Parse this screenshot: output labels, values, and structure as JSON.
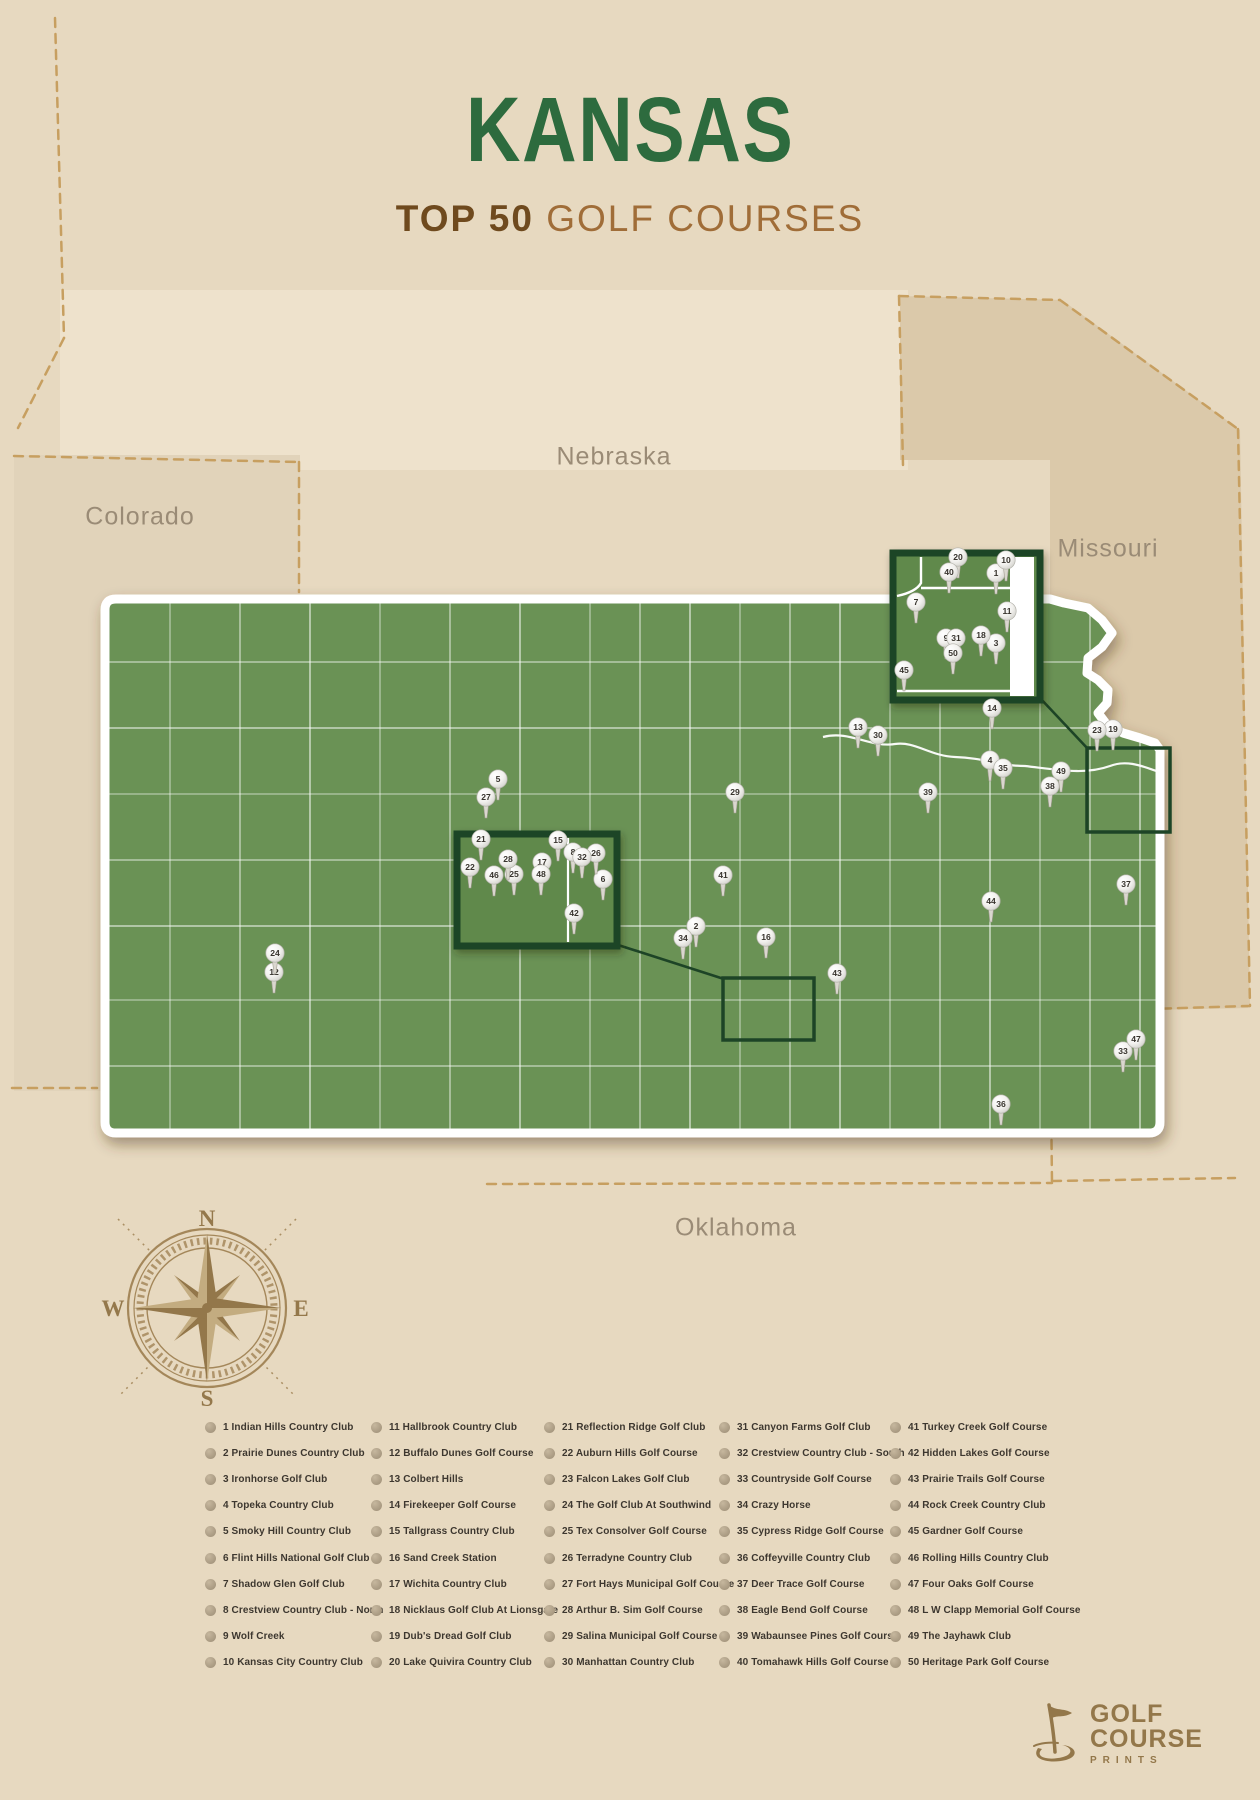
{
  "title": {
    "main": "KANSAS",
    "subtitle_bold": "TOP 50",
    "subtitle_light": " GOLF COURSES"
  },
  "states": [
    {
      "name": "Colorado",
      "x": 140,
      "y": 517
    },
    {
      "name": "Nebraska",
      "x": 614,
      "y": 457
    },
    {
      "name": "Missouri",
      "x": 1108,
      "y": 549
    },
    {
      "name": "Oklahoma",
      "x": 736,
      "y": 1228
    }
  ],
  "compass": {
    "n": "N",
    "e": "E",
    "s": "S",
    "w": "W"
  },
  "colors": {
    "background": "#e7d9c0",
    "map_green": "#6b9254",
    "inset_green": "#61894b",
    "inset_border": "#1d4426",
    "title_green": "#2d6b3e",
    "brown_dark": "#6f4a1e",
    "brown_light": "#a06d38",
    "dashed_border": "#c79f60",
    "legend_text": "#3d372f",
    "compass": "#94784b",
    "logo": "#93774a"
  },
  "map": {
    "markers": [
      {
        "n": 1,
        "x": 996,
        "y": 573
      },
      {
        "n": 2,
        "x": 696,
        "y": 926
      },
      {
        "n": 3,
        "x": 996,
        "y": 643
      },
      {
        "n": 4,
        "x": 990,
        "y": 760
      },
      {
        "n": 5,
        "x": 498,
        "y": 779
      },
      {
        "n": 6,
        "x": 603,
        "y": 879
      },
      {
        "n": 7,
        "x": 916,
        "y": 602
      },
      {
        "n": 8,
        "x": 573,
        "y": 852
      },
      {
        "n": 9,
        "x": 946,
        "y": 638
      },
      {
        "n": 10,
        "x": 1006,
        "y": 560
      },
      {
        "n": 11,
        "x": 1007,
        "y": 611
      },
      {
        "n": 12,
        "x": 274,
        "y": 972
      },
      {
        "n": 13,
        "x": 858,
        "y": 727
      },
      {
        "n": 14,
        "x": 992,
        "y": 708
      },
      {
        "n": 15,
        "x": 558,
        "y": 840
      },
      {
        "n": 16,
        "x": 766,
        "y": 937
      },
      {
        "n": 17,
        "x": 542,
        "y": 862
      },
      {
        "n": 18,
        "x": 981,
        "y": 635
      },
      {
        "n": 19,
        "x": 1113,
        "y": 729
      },
      {
        "n": 20,
        "x": 958,
        "y": 557
      },
      {
        "n": 21,
        "x": 481,
        "y": 839
      },
      {
        "n": 22,
        "x": 470,
        "y": 867
      },
      {
        "n": 23,
        "x": 1097,
        "y": 730
      },
      {
        "n": 24,
        "x": 275,
        "y": 953
      },
      {
        "n": 25,
        "x": 514,
        "y": 874
      },
      {
        "n": 26,
        "x": 596,
        "y": 853
      },
      {
        "n": 27,
        "x": 486,
        "y": 797
      },
      {
        "n": 28,
        "x": 508,
        "y": 859
      },
      {
        "n": 29,
        "x": 735,
        "y": 792
      },
      {
        "n": 30,
        "x": 878,
        "y": 735
      },
      {
        "n": 31,
        "x": 956,
        "y": 638
      },
      {
        "n": 32,
        "x": 582,
        "y": 857
      },
      {
        "n": 33,
        "x": 1123,
        "y": 1051
      },
      {
        "n": 34,
        "x": 683,
        "y": 938
      },
      {
        "n": 35,
        "x": 1003,
        "y": 768
      },
      {
        "n": 36,
        "x": 1001,
        "y": 1104
      },
      {
        "n": 37,
        "x": 1126,
        "y": 884
      },
      {
        "n": 38,
        "x": 1050,
        "y": 786
      },
      {
        "n": 39,
        "x": 928,
        "y": 792
      },
      {
        "n": 40,
        "x": 949,
        "y": 572
      },
      {
        "n": 41,
        "x": 723,
        "y": 875
      },
      {
        "n": 42,
        "x": 574,
        "y": 913
      },
      {
        "n": 43,
        "x": 837,
        "y": 973
      },
      {
        "n": 44,
        "x": 991,
        "y": 901
      },
      {
        "n": 45,
        "x": 904,
        "y": 670
      },
      {
        "n": 46,
        "x": 494,
        "y": 875
      },
      {
        "n": 47,
        "x": 1136,
        "y": 1039
      },
      {
        "n": 48,
        "x": 541,
        "y": 874
      },
      {
        "n": 49,
        "x": 1061,
        "y": 771
      },
      {
        "n": 50,
        "x": 953,
        "y": 653
      }
    ]
  },
  "legend": {
    "columns": [
      [
        {
          "num": "1",
          "name": "Indian Hills Country Club"
        },
        {
          "num": "2",
          "name": "Prairie Dunes Country Club"
        },
        {
          "num": "3",
          "name": "Ironhorse Golf Club"
        },
        {
          "num": "4",
          "name": "Topeka Country Club"
        },
        {
          "num": "5",
          "name": "Smoky Hill Country Club"
        },
        {
          "num": "6",
          "name": "Flint Hills National Golf Club"
        },
        {
          "num": "7",
          "name": "Shadow Glen Golf Club"
        },
        {
          "num": "8",
          "name": "Crestview Country Club - North"
        },
        {
          "num": "9",
          "name": "Wolf Creek"
        },
        {
          "num": "10",
          "name": "Kansas City Country Club"
        }
      ],
      [
        {
          "num": "11",
          "name": "Hallbrook Country Club"
        },
        {
          "num": "12",
          "name": "Buffalo Dunes Golf Course"
        },
        {
          "num": "13",
          "name": "Colbert Hills"
        },
        {
          "num": "14",
          "name": "Firekeeper Golf Course"
        },
        {
          "num": "15",
          "name": "Tallgrass Country Club"
        },
        {
          "num": "16",
          "name": "Sand Creek Station"
        },
        {
          "num": "17",
          "name": "Wichita Country Club"
        },
        {
          "num": "18",
          "name": "Nicklaus Golf Club At Lionsgate"
        },
        {
          "num": "19",
          "name": "Dub's Dread Golf Club"
        },
        {
          "num": "20",
          "name": "Lake Quivira Country Club"
        }
      ],
      [
        {
          "num": "21",
          "name": "Reflection Ridge Golf Club"
        },
        {
          "num": "22",
          "name": "Auburn Hills Golf Course"
        },
        {
          "num": "23",
          "name": "Falcon Lakes Golf Club"
        },
        {
          "num": "24",
          "name": "The Golf Club At Southwind"
        },
        {
          "num": "25",
          "name": "Tex Consolver Golf Course"
        },
        {
          "num": "26",
          "name": "Terradyne Country Club"
        },
        {
          "num": "27",
          "name": "Fort Hays Municipal Golf Course"
        },
        {
          "num": "28",
          "name": "Arthur B. Sim Golf Course"
        },
        {
          "num": "29",
          "name": "Salina Municipal Golf Course"
        },
        {
          "num": "30",
          "name": "Manhattan Country Club"
        }
      ],
      [
        {
          "num": "31",
          "name": "Canyon Farms Golf Club"
        },
        {
          "num": "32",
          "name": "Crestview Country Club - South"
        },
        {
          "num": "33",
          "name": "Countryside Golf Course"
        },
        {
          "num": "34",
          "name": "Crazy Horse"
        },
        {
          "num": "35",
          "name": "Cypress Ridge Golf Course"
        },
        {
          "num": "36",
          "name": "Coffeyville Country Club"
        },
        {
          "num": "37",
          "name": "Deer Trace Golf Course"
        },
        {
          "num": "38",
          "name": "Eagle Bend Golf Course"
        },
        {
          "num": "39",
          "name": "Wabaunsee Pines Golf Course"
        },
        {
          "num": "40",
          "name": "Tomahawk Hills Golf Course"
        }
      ],
      [
        {
          "num": "41",
          "name": "Turkey Creek Golf Course"
        },
        {
          "num": "42",
          "name": "Hidden Lakes Golf Course"
        },
        {
          "num": "43",
          "name": "Prairie Trails Golf Course"
        },
        {
          "num": "44",
          "name": "Rock Creek Country Club"
        },
        {
          "num": "45",
          "name": "Gardner Golf Course"
        },
        {
          "num": "46",
          "name": "Rolling Hills Country Club"
        },
        {
          "num": "47",
          "name": "Four Oaks Golf Course"
        },
        {
          "num": "48",
          "name": "L W Clapp Memorial Golf Course"
        },
        {
          "num": "49",
          "name": "The Jayhawk Club"
        },
        {
          "num": "50",
          "name": "Heritage Park Golf Course"
        }
      ]
    ]
  },
  "logo": {
    "line1": "GOLF",
    "line2": "COURSE",
    "line3": "PRINTS"
  }
}
